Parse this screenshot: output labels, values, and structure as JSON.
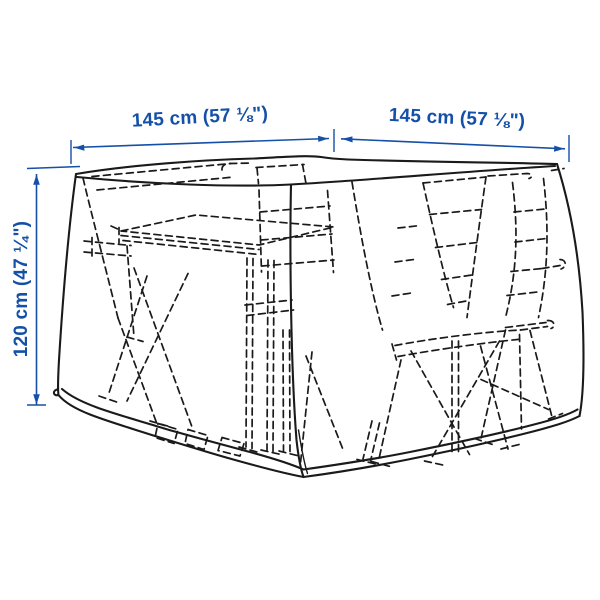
{
  "canvas": {
    "background": "#ffffff"
  },
  "palette": {
    "dimension_blue": "#1450a8",
    "sketch_ink": "#1a1a1a"
  },
  "figure": {
    "name": "furniture-cover-dimension-sketch",
    "subject": "Protective cover drawn solid over a dashed outdoor dining table and folding chairs"
  },
  "dimensions": {
    "width_left_label": "145 cm (57 ⅛\")",
    "width_right_label": "145 cm (57 ⅛\")",
    "height_label": "120 cm (47 ¼\")"
  }
}
